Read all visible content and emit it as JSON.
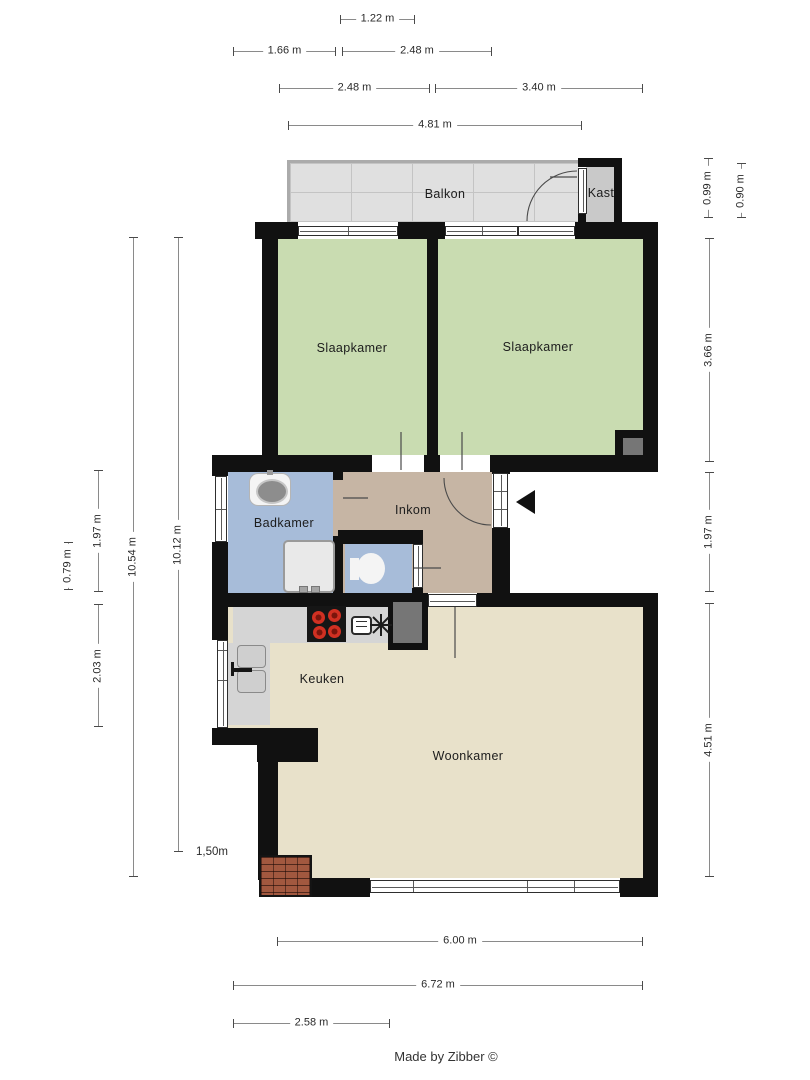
{
  "credit": "Made by Zibber ©",
  "colors": {
    "wall": "#111111",
    "green": "#c9dcb1",
    "blue": "#a7bcd9",
    "tan": "#c6b5a4",
    "beige": "#e8e1ca",
    "tile": "#e0e0e0",
    "gray": "#c9c9c9",
    "counter": "#d5d5d5",
    "shaft": "#767676",
    "brick": "#a2583f",
    "arrow": "#111111"
  },
  "floors": [
    {
      "name": "balkon-floor",
      "fill": "tile",
      "cls": "tiles",
      "r": [
        290,
        163,
        288,
        59
      ]
    },
    {
      "name": "slaapkamer-links-floor",
      "fill": "green",
      "r": [
        278,
        239,
        149,
        216
      ]
    },
    {
      "name": "slaapkamer-rechts-floor",
      "fill": "green",
      "r": [
        438,
        239,
        205,
        216
      ]
    },
    {
      "name": "badkamer-floor",
      "fill": "blue",
      "r": [
        228,
        472,
        105,
        121
      ]
    },
    {
      "name": "inkom-floor",
      "fill": "tan",
      "r": [
        343,
        472,
        149,
        121
      ]
    },
    {
      "name": "badkamer-door-gap",
      "fill": "tan",
      "r": [
        333,
        480,
        10,
        56
      ]
    },
    {
      "name": "toilet-floor",
      "fill": "blue",
      "r": [
        345,
        544,
        67,
        49
      ]
    },
    {
      "name": "woonkamer-floor",
      "fill": "beige",
      "r": [
        278,
        607,
        365,
        271
      ]
    },
    {
      "name": "keuken-nook-floor",
      "fill": "beige",
      "r": [
        228,
        607,
        50,
        121
      ]
    }
  ],
  "pre_walls": [
    {
      "name": "balkon-railing-left",
      "fill": "rail",
      "r": [
        287,
        160,
        3,
        62
      ]
    },
    {
      "name": "balkon-railing-top",
      "fill": "rail",
      "r": [
        287,
        160,
        291,
        3
      ]
    },
    {
      "name": "counter-top",
      "fill": "counter",
      "r": [
        233,
        605,
        155,
        38
      ]
    },
    {
      "name": "counter-left",
      "fill": "counter",
      "r": [
        228,
        643,
        42,
        82
      ]
    }
  ],
  "walls": [
    [
      255,
      222,
      43,
      17
    ],
    [
      398,
      222,
      47,
      17
    ],
    [
      575,
      222,
      83,
      17
    ],
    [
      262,
      239,
      16,
      233
    ],
    [
      578,
      158,
      44,
      9
    ],
    [
      614,
      158,
      8,
      64
    ],
    [
      578,
      214,
      9,
      8
    ],
    [
      427,
      239,
      11,
      216
    ],
    [
      643,
      239,
      15,
      233
    ],
    [
      212,
      455,
      160,
      17
    ],
    [
      424,
      455,
      16,
      17
    ],
    [
      490,
      455,
      168,
      17
    ],
    [
      212,
      472,
      16,
      4
    ],
    [
      212,
      542,
      16,
      63
    ],
    [
      333,
      472,
      10,
      8
    ],
    [
      333,
      536,
      10,
      57
    ],
    [
      338,
      530,
      85,
      14
    ],
    [
      412,
      588,
      11,
      8
    ],
    [
      492,
      466,
      18,
      8
    ],
    [
      492,
      528,
      18,
      79
    ],
    [
      212,
      593,
      176,
      14
    ],
    [
      388,
      593,
      40,
      57
    ],
    [
      477,
      593,
      181,
      14
    ],
    [
      643,
      607,
      15,
      290
    ],
    [
      212,
      607,
      16,
      33
    ],
    [
      212,
      728,
      106,
      17
    ],
    [
      257,
      745,
      61,
      17
    ],
    [
      258,
      762,
      20,
      118
    ],
    [
      312,
      878,
      58,
      19
    ],
    [
      620,
      878,
      38,
      19
    ],
    [
      615,
      430,
      8,
      25
    ],
    [
      615,
      430,
      43,
      8
    ]
  ],
  "insets": [
    {
      "name": "kast-floor",
      "fill": "gray",
      "r": [
        586,
        167,
        28,
        55
      ]
    },
    {
      "name": "shaft-keuken",
      "fill": "shaft",
      "r": [
        393,
        602,
        29,
        41
      ]
    },
    {
      "name": "shaft-slaapkamer",
      "fill": "shaft",
      "r": [
        623,
        438,
        20,
        17
      ]
    }
  ],
  "brick": {
    "name": "brick-corner",
    "r": [
      259,
      855,
      53,
      42
    ]
  },
  "windows": [
    {
      "name": "window-slaapkamer-links",
      "o": "h",
      "r": [
        298,
        226,
        100,
        10
      ],
      "divs": [
        0.5
      ]
    },
    {
      "name": "window-slaapkamer-rechts",
      "o": "h",
      "r": [
        445,
        226,
        73,
        10
      ],
      "divs": [
        0.5
      ]
    },
    {
      "name": "balkon-deur",
      "o": "h",
      "r": [
        518,
        226,
        57,
        10
      ],
      "divs": []
    },
    {
      "name": "kast-deur",
      "o": "v",
      "r": [
        578,
        168,
        9,
        46
      ],
      "divs": []
    },
    {
      "name": "window-badkamer",
      "o": "v",
      "r": [
        215,
        476,
        12,
        66
      ],
      "divs": [
        0.5
      ]
    },
    {
      "name": "voordeur",
      "o": "v",
      "r": [
        493,
        473,
        15,
        55
      ],
      "divs": [
        0.33,
        0.66
      ]
    },
    {
      "name": "toilet-deur",
      "o": "v",
      "r": [
        413,
        544,
        10,
        44
      ],
      "divs": []
    },
    {
      "name": "window-keuken",
      "o": "v",
      "r": [
        217,
        640,
        11,
        88
      ],
      "divs": [
        0.1,
        0.45
      ]
    },
    {
      "name": "deur-inkom-woonkamer",
      "o": "h",
      "r": [
        428,
        594,
        49,
        13
      ],
      "divs": []
    },
    {
      "name": "window-woonkamer",
      "o": "h",
      "r": [
        370,
        880,
        250,
        13
      ],
      "divs": [
        0.17,
        0.63,
        0.82
      ]
    }
  ],
  "fixtures": [
    {
      "type": "sink",
      "name": "badkamer-sink",
      "r": [
        249,
        473,
        42,
        33
      ],
      "bowl": [
        6,
        5,
        28,
        21
      ],
      "tap": [
        18,
        -3,
        6,
        5
      ]
    },
    {
      "type": "shower",
      "name": "badkamer-shower",
      "r": [
        283,
        540,
        52,
        53
      ],
      "knobs": [
        [
          14,
          44,
          7,
          5
        ],
        [
          26,
          44,
          7,
          5
        ]
      ]
    },
    {
      "type": "toilet",
      "name": "toilet-fixture",
      "bowl": [
        357,
        553,
        28,
        31
      ],
      "tank": [
        350,
        558,
        9,
        22
      ]
    },
    {
      "type": "fridge",
      "name": "keuken-fridge",
      "doors": [
        [
          237,
          645,
          29,
          23
        ],
        [
          237,
          670,
          29,
          23
        ]
      ],
      "handle": [
        [
          231,
          662,
          3,
          14
        ],
        [
          233,
          668,
          19,
          4
        ]
      ]
    },
    {
      "type": "cooktop",
      "name": "keuken-cooktop",
      "r": [
        307,
        606,
        39,
        36
      ],
      "burners": [
        [
          5,
          5
        ],
        [
          21,
          3
        ],
        [
          6,
          20
        ],
        [
          21,
          19
        ]
      ]
    },
    {
      "type": "oven",
      "name": "keuken-oven-icon",
      "r": [
        351,
        616,
        21,
        19
      ]
    }
  ],
  "svg": {
    "arcs": [
      {
        "name": "door-swing-voordeur",
        "d": "M444,478 A47,47 0 0 0 491,525"
      },
      {
        "name": "door-swing-balkon",
        "d": "M527,221 A50,50 0 0 1 577,171"
      }
    ],
    "leaves": [
      [
        401,
        432,
        401,
        470
      ],
      [
        462,
        432,
        462,
        470
      ],
      [
        343,
        498,
        368,
        498
      ],
      [
        414,
        568,
        441,
        568
      ],
      [
        455,
        607,
        455,
        658
      ],
      [
        550,
        177,
        577,
        177
      ]
    ],
    "fan": [
      [
        381,
        614,
        381,
        636
      ],
      [
        370,
        625,
        392,
        625
      ],
      [
        373,
        617,
        389,
        633
      ],
      [
        373,
        633,
        389,
        617
      ]
    ],
    "arrow_points": "516,502 535,490 535,514"
  },
  "room_labels": [
    {
      "t": "Balkon",
      "x": 445,
      "y": 194
    },
    {
      "t": "Kast",
      "x": 601,
      "y": 193
    },
    {
      "t": "Slaapkamer",
      "x": 352,
      "y": 348
    },
    {
      "t": "Slaapkamer",
      "x": 538,
      "y": 347
    },
    {
      "t": "Badkamer",
      "x": 284,
      "y": 523
    },
    {
      "t": "Inkom",
      "x": 413,
      "y": 510
    },
    {
      "t": "Keuken",
      "x": 322,
      "y": 679
    },
    {
      "t": "Woonkamer",
      "x": 468,
      "y": 756
    }
  ],
  "dimensions": [
    {
      "label": "1.22 m",
      "o": "h",
      "x": 340,
      "y": 19,
      "len": 75
    },
    {
      "label": "1.66 m",
      "o": "h",
      "x": 233,
      "y": 51,
      "len": 103
    },
    {
      "label": "2.48 m",
      "o": "h",
      "x": 342,
      "y": 51,
      "len": 150
    },
    {
      "label": "2.48 m",
      "o": "h",
      "x": 279,
      "y": 88,
      "len": 151
    },
    {
      "label": "3.40 m",
      "o": "h",
      "x": 435,
      "y": 88,
      "len": 208
    },
    {
      "label": "4.81 m",
      "o": "h",
      "x": 288,
      "y": 125,
      "len": 294
    },
    {
      "label": "6.00 m",
      "o": "h",
      "x": 277,
      "y": 941,
      "len": 366
    },
    {
      "label": "6.72 m",
      "o": "h",
      "x": 233,
      "y": 985,
      "len": 410
    },
    {
      "label": "2.58 m",
      "o": "h",
      "x": 233,
      "y": 1023,
      "len": 157
    },
    {
      "label": "0.79 m",
      "o": "v",
      "x": 68,
      "y": 542,
      "len": 48
    },
    {
      "label": "1.97 m",
      "o": "v",
      "x": 98,
      "y": 470,
      "len": 122
    },
    {
      "label": "2.03 m",
      "o": "v",
      "x": 98,
      "y": 604,
      "len": 123
    },
    {
      "label": "10.54 m",
      "o": "v",
      "x": 133,
      "y": 237,
      "len": 640
    },
    {
      "label": "10.12 m",
      "o": "v",
      "x": 178,
      "y": 237,
      "len": 615
    },
    {
      "label": "0.99 m",
      "o": "v",
      "x": 708,
      "y": 158,
      "len": 60
    },
    {
      "label": "0.90 m",
      "o": "v",
      "x": 741,
      "y": 163,
      "len": 55
    },
    {
      "label": "3.66 m",
      "o": "v",
      "x": 709,
      "y": 238,
      "len": 224
    },
    {
      "label": "1.97 m",
      "o": "v",
      "x": 709,
      "y": 472,
      "len": 120
    },
    {
      "label": "4.51 m",
      "o": "v",
      "x": 709,
      "y": 603,
      "len": 274
    }
  ],
  "free_labels": [
    {
      "t": "1,50m",
      "x": 196,
      "y": 846
    }
  ]
}
